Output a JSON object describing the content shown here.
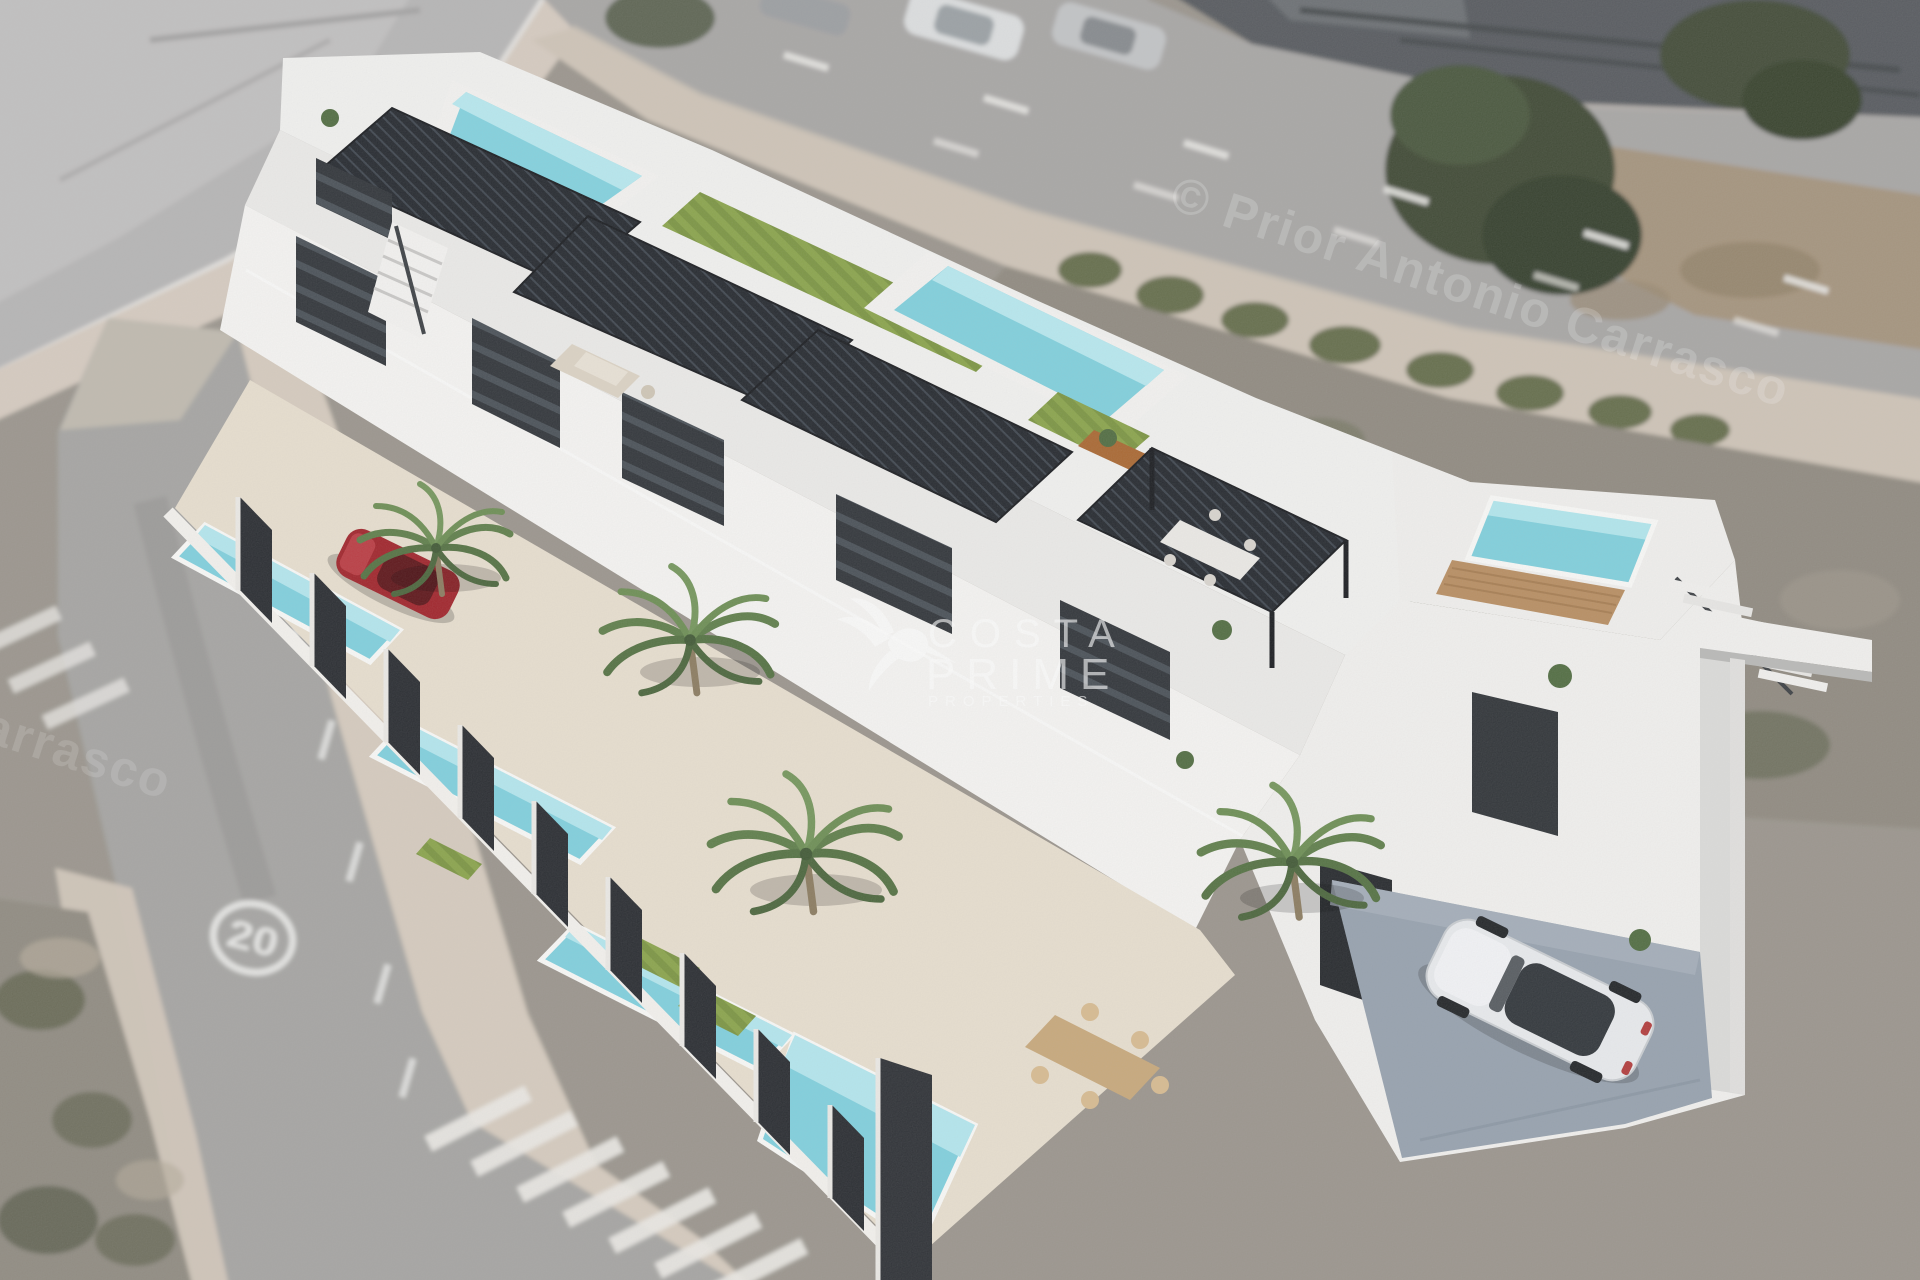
{
  "watermark_brand": {
    "logo_icon": "hummingbird-logo",
    "line1": "COSTA",
    "line2": "PRIME",
    "line3": "PROPERTIES",
    "text_color": "#ffffff"
  },
  "watermark_copyright": {
    "text": "© Prior Antonio Carrasco",
    "text_color": "#ffffff"
  },
  "road_markings": {
    "speed_limit_label": "20"
  },
  "palette": {
    "wall_white": "#f2f1ef",
    "pergola_dark": "#22262c",
    "pool_water": "#7fd0dd",
    "pool_light": "#b7e9f0",
    "turf_green": "#89a349",
    "patio_beige": "#e8dfcf",
    "road_gray": "#a5a4a2",
    "sidewalk_pink": "#d6cbbe",
    "dirt_gray": "#8f897f",
    "driveway_gray_blue": "#96a1ae",
    "car_red": "#a02128",
    "car_white": "#e9ebee"
  }
}
